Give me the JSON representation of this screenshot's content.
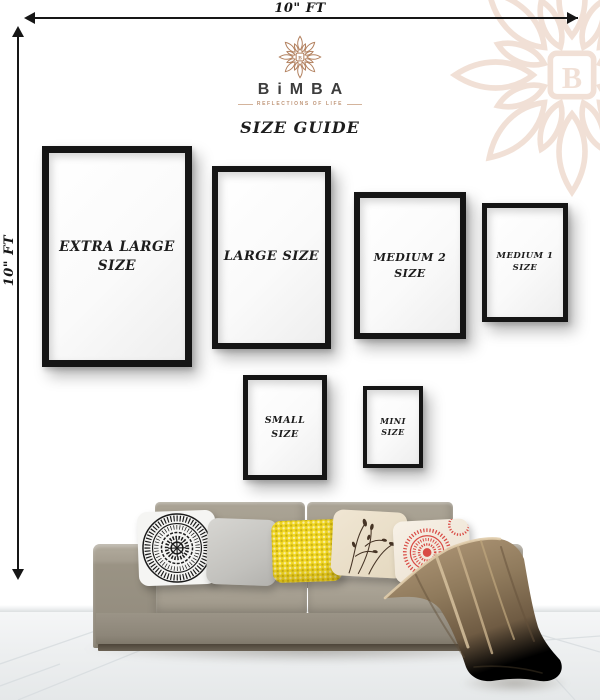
{
  "poster": {
    "width_label": "10\" FT",
    "height_label": "10\" FT"
  },
  "brand": {
    "wordmark": "BiMBA",
    "tagline": "REFLECTIONS OF LIFE",
    "heading": "SIZE GUIDE",
    "logo_letter": "B"
  },
  "frames": [
    {
      "id": "extra-large",
      "line1": "EXTRA LARGE",
      "line2": "SIZE"
    },
    {
      "id": "large",
      "line1": "LARGE SIZE",
      "line2": ""
    },
    {
      "id": "medium-2",
      "line1": "MEDIUM 2",
      "line2": "SIZE"
    },
    {
      "id": "medium-1",
      "line1": "MEDIUM 1",
      "line2": "SIZE"
    },
    {
      "id": "small",
      "line1": "SMALL",
      "line2": "SIZE"
    },
    {
      "id": "mini",
      "line1": "MINI",
      "line2": "SIZE"
    }
  ],
  "colors": {
    "logo_tan": "#b2805e",
    "watermark_tan": "#e8cdbb",
    "frame_black": "#151515",
    "sofa_fabric": "#a0998b",
    "pillow_gray": "#c6c5c1",
    "pillow_yellow": "#f2d822",
    "pillow_red": "#d94b45",
    "pillow_beige": "#ece1cb",
    "blanket_tan": "#9b8465"
  },
  "scene": {
    "pillows": [
      {
        "id": "black-white-mandala"
      },
      {
        "id": "plain-gray"
      },
      {
        "id": "yellow-dotted"
      },
      {
        "id": "beige-botanical"
      },
      {
        "id": "red-medallion"
      }
    ]
  }
}
